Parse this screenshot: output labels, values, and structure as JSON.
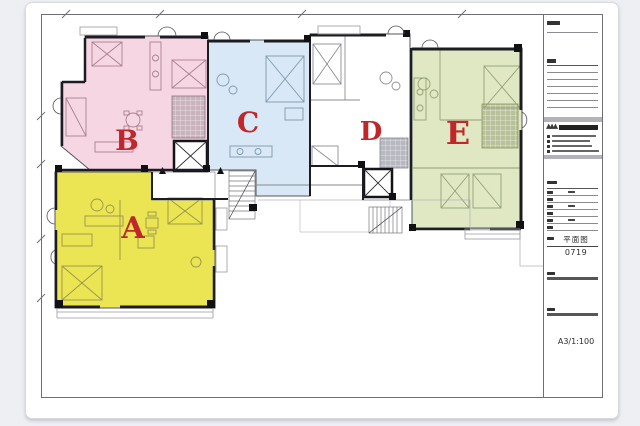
{
  "page": {
    "background_color": "#edeff3",
    "paper_color": "#ffffff"
  },
  "plan": {
    "type": "architectural-floor-plan",
    "label_color": "#bf272b",
    "wall_color": "#3e3e46",
    "units": [
      {
        "id": "A",
        "label": "A",
        "color": "#ebe553",
        "position": "bottom-left"
      },
      {
        "id": "B",
        "label": "B",
        "color": "#f7d6e3",
        "position": "top-left"
      },
      {
        "id": "C",
        "label": "C",
        "color": "#d8e8f6",
        "position": "top-center"
      },
      {
        "id": "D",
        "label": "D",
        "color": "#ffffff",
        "position": "center-right"
      },
      {
        "id": "E",
        "label": "E",
        "color": "#dfe8c2",
        "position": "right"
      }
    ],
    "core_elements": [
      "elevator-shaft",
      "elevator-shaft",
      "staircase",
      "staircase",
      "entry-lobby"
    ]
  },
  "title_block": {
    "drawing_title": "平面图",
    "drawing_number": "0719",
    "sheet_and_scale": "A3/1:100"
  }
}
